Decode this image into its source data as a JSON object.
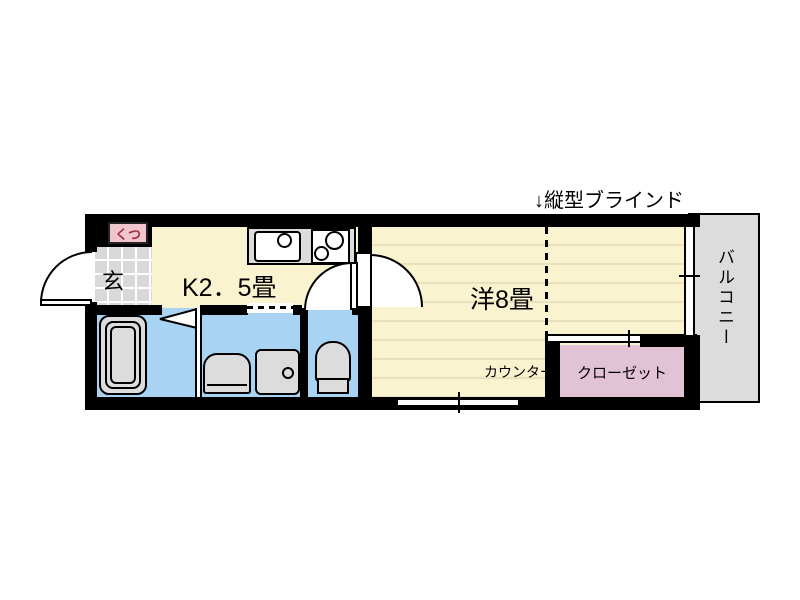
{
  "labels": {
    "vertical_blind": "↓縦型ブラインド"
  },
  "rooms": {
    "entrance": {
      "label": "玄"
    },
    "shoe_box": {
      "label": "くつ"
    },
    "kitchen": {
      "label": "K2．5畳"
    },
    "western_room": {
      "label": "洋8畳"
    },
    "counter": {
      "label": "カウンター"
    },
    "closet": {
      "label": "クローゼット"
    },
    "balcony": {
      "label": "バルコニー"
    }
  },
  "fixtures": {
    "bathtub": "bathtub",
    "kitchen_sink": "kitchen-sink",
    "stove": "two-burner-stove",
    "washbasin": "washbasin",
    "washer_pan": "washing-machine-pan",
    "toilet": "toilet"
  },
  "colors": {
    "wall": "#000000",
    "cream": "#FAF3CF",
    "floor_line": "#E9E1BD",
    "water": "#A9D3F3",
    "tile": "#D9D9D9",
    "fixture": "#DCDCDC",
    "closet": "#E2C3D5",
    "shoebox": "#F0C5CD",
    "shoebox_text": "#A03040",
    "balcony": "#DCDCDC",
    "bg": "#FFFFFF",
    "ink": "#000000"
  }
}
